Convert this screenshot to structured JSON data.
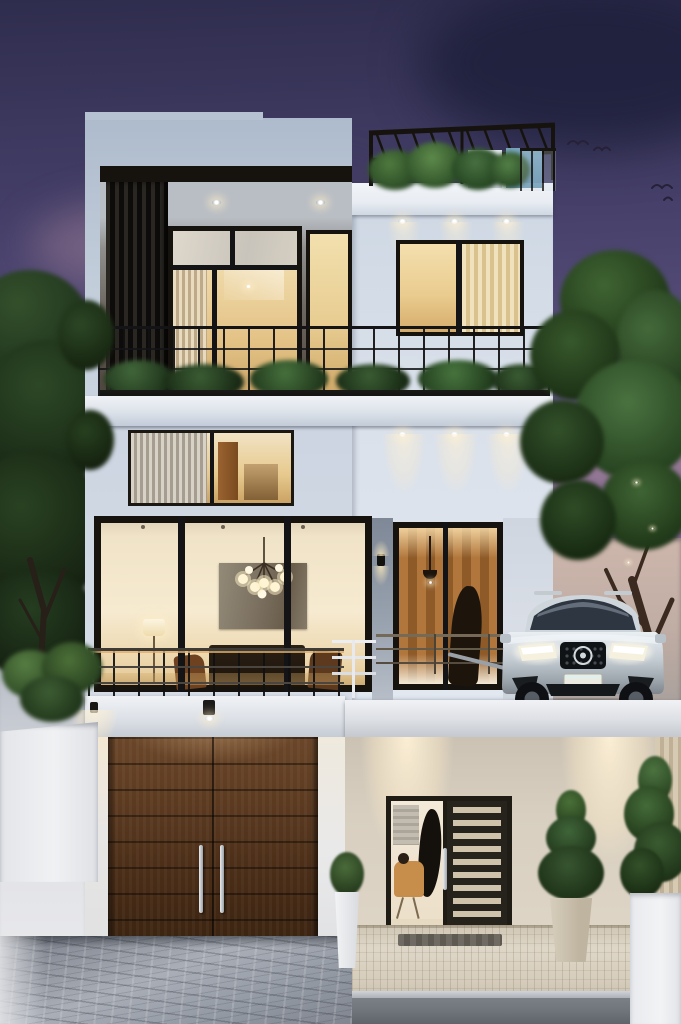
{
  "scene": {
    "type": "exterior architectural rendering",
    "time_of_day": "dusk",
    "subject": "Modern three-storey white house at dusk with rooftop pergola terrace, glass balconies, wooden double garage door, slatted front entry door and a silver SUV parked on the raised driveway, framed by trees and conifer planters"
  },
  "palette": {
    "sky_top": "#2f2d4e",
    "sky_mid": "#5f5580",
    "sky_pink": "#c99fae",
    "cloud_plum": "#4a3c60",
    "facade_light": "#dde3ec",
    "facade_mid": "#bfcbd9",
    "facade_dark": "#9fadc0",
    "fascia": "#e9edf3",
    "frame_dark": "#16130f",
    "louver": "#0e0c0a",
    "warm_light": "#f2d49a",
    "warm_deep": "#cf9a55",
    "interior_cream": "#f4e6c9",
    "wood_interior": "#a76f36",
    "garage_wood": "#5e3d22",
    "garage_wood_dark": "#331e0e",
    "foliage_dark": "#20331d",
    "foliage_mid": "#35552c",
    "foliage_light": "#4f7a3e",
    "railing": "#232325",
    "car_silver": "#c7cfd6",
    "glass_blue": "#7fb0c9",
    "pavement": "#9aa1ab",
    "path_beige": "#ded6c7",
    "street": "#70747b",
    "wall_white": "#eef0f2"
  },
  "elements": {
    "sky": "purple-pink dusk sky with clouds",
    "birds": "distant birds, upper right",
    "rooftop_terrace": "black pergola frame, terrace plants, blue glass screen",
    "upper_balcony": "recessed balcony with dark louvers, warm-lit glazing, black railing with planter greenery",
    "middle_floor": "horizontal strip window with sheer curtains and warm interior; recessed downlights",
    "living_floor": "full-height black-framed glass wall showing chandelier, wall art, floor lamp and furniture; tall wood-lined entry glazing",
    "vehicle": "silver SUV, lit headlights, dark grille with round emblem",
    "garage": "dark wooden double garage door with twin steel pull handles",
    "entrance": "black front door with horizontal slats and glass sidelight showing a home office",
    "landscape": "dark tree left, green tree right, conifers in white and stone planters, cobblestone driveway, pale stone entry path, grey street"
  }
}
